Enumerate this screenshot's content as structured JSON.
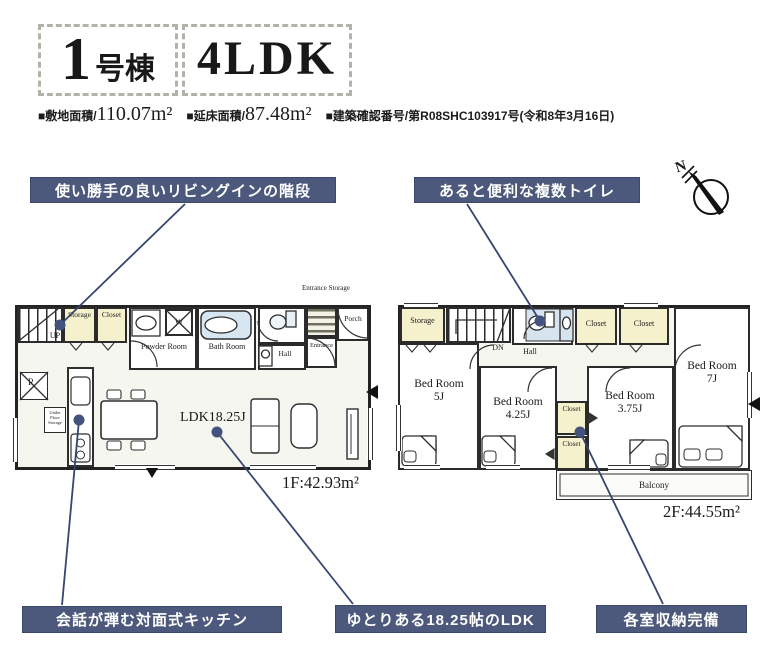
{
  "header": {
    "building_number": "1",
    "building_suffix": "号棟",
    "plan_type": "4LDK",
    "specs": [
      {
        "label": "■敷地面積/",
        "value": "110.07m²"
      },
      {
        "label": "■延床面積/",
        "value": "87.48m²"
      },
      {
        "label": "■建築確認番号/",
        "value": "第R08SHC103917号(令和8年3月16日)"
      }
    ]
  },
  "callouts": {
    "living_stairs": "使い勝手の良いリビングインの階段",
    "multiple_toilets": "あると便利な複数トイレ",
    "kitchen": "会話が弾む対面式キッチン",
    "ldk": "ゆとりある18.25帖のLDK",
    "storage": "各室収納完備"
  },
  "compass": {
    "north": "N"
  },
  "floor1": {
    "area": "1F:42.93m²",
    "entrance_storage": "Entrance Storage",
    "rooms": {
      "up": "UP",
      "storage": "Storage",
      "closet": "Closet",
      "powder": "Powder Room",
      "bath": "Bath Room",
      "hall": "Hall",
      "entrance": "Entrance",
      "porch": "Porch",
      "ldk": "LDK18.25J",
      "fridge": "R",
      "washer": "W",
      "underfloor": "Under Floor Storage"
    }
  },
  "floor2": {
    "area": "2F:44.55m²",
    "rooms": {
      "storage": "Storage",
      "dn": "DN",
      "hall": "Hall",
      "closet_a": "Closet",
      "closet_b": "Closet",
      "closet_small": "Closet",
      "bed5": "Bed Room 5J",
      "bed425": "Bed Room 4.25J",
      "bed375": "Bed Room 3.75J",
      "bed7": "Bed Room 7J",
      "balcony": "Balcony"
    }
  },
  "colors": {
    "callout_bg": "#4d597c",
    "connector_line": "#36466f",
    "closet_cream": "#f5f1cd",
    "bath_blue": "#d8e6f1"
  }
}
